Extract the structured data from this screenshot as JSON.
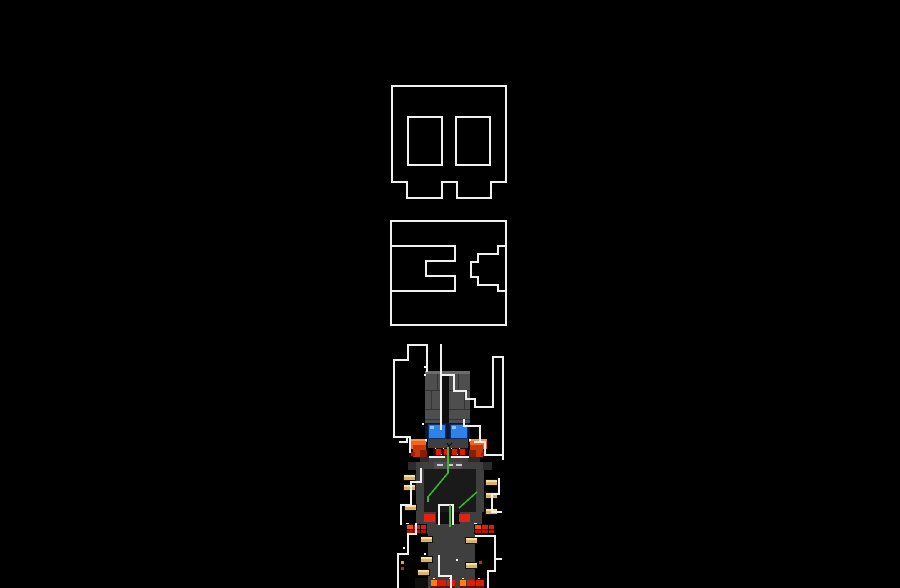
{
  "scene": {
    "background": "#000000",
    "kind": "pixel-art-game-scene"
  },
  "palette": {
    "bg": "#000000",
    "letter": "#f0f0f0",
    "gray_hi": "#6b6b6b",
    "gray_mid": "#4e4e4e",
    "gray_low": "#3f3f3f",
    "gray_dim": "#2b2b2b",
    "gray_dark": "#1a1a1a",
    "near_black": "#0e0e0e",
    "seam": "#333333",
    "eye_band": "#0c1630",
    "eye_border": "#0a2f6e",
    "eye_fill": "#2f82e8",
    "eye_spark": "#8cc2ff",
    "metal_hi": "#c9c9c9",
    "orange_hi": "#ff9440",
    "orange": "#f4641c",
    "red_deep": "#c33808",
    "red_dark": "#8a1d04",
    "red_bright": "#dd1d0c",
    "red_mid": "#b01505",
    "red_shadow": "#6b0e03",
    "brick_orange": "#f0520e",
    "feet_orange": "#ff7d12",
    "waist_red": "#e02313",
    "teeth_bg": "#2b0b04",
    "tan_border": "#16120a",
    "tan": "#d9b36a",
    "tan_hi": "#f3e0a0",
    "green": "#3db829",
    "white": "#ffffff"
  },
  "glyphs": {
    "stroke_width": "2.2",
    "top_glyph": "skull-b-outline",
    "middle_glyph": "e-bracket-outline",
    "head_overlay_glyph": "staircase-tube-outline",
    "body_overlay_glyph": "zigzag-frame-outline"
  },
  "robot": {
    "eye_color_name": "blue",
    "shoulder_color_name": "orange-red",
    "wire_color_name": "green",
    "ammo_color_name": "tan"
  }
}
